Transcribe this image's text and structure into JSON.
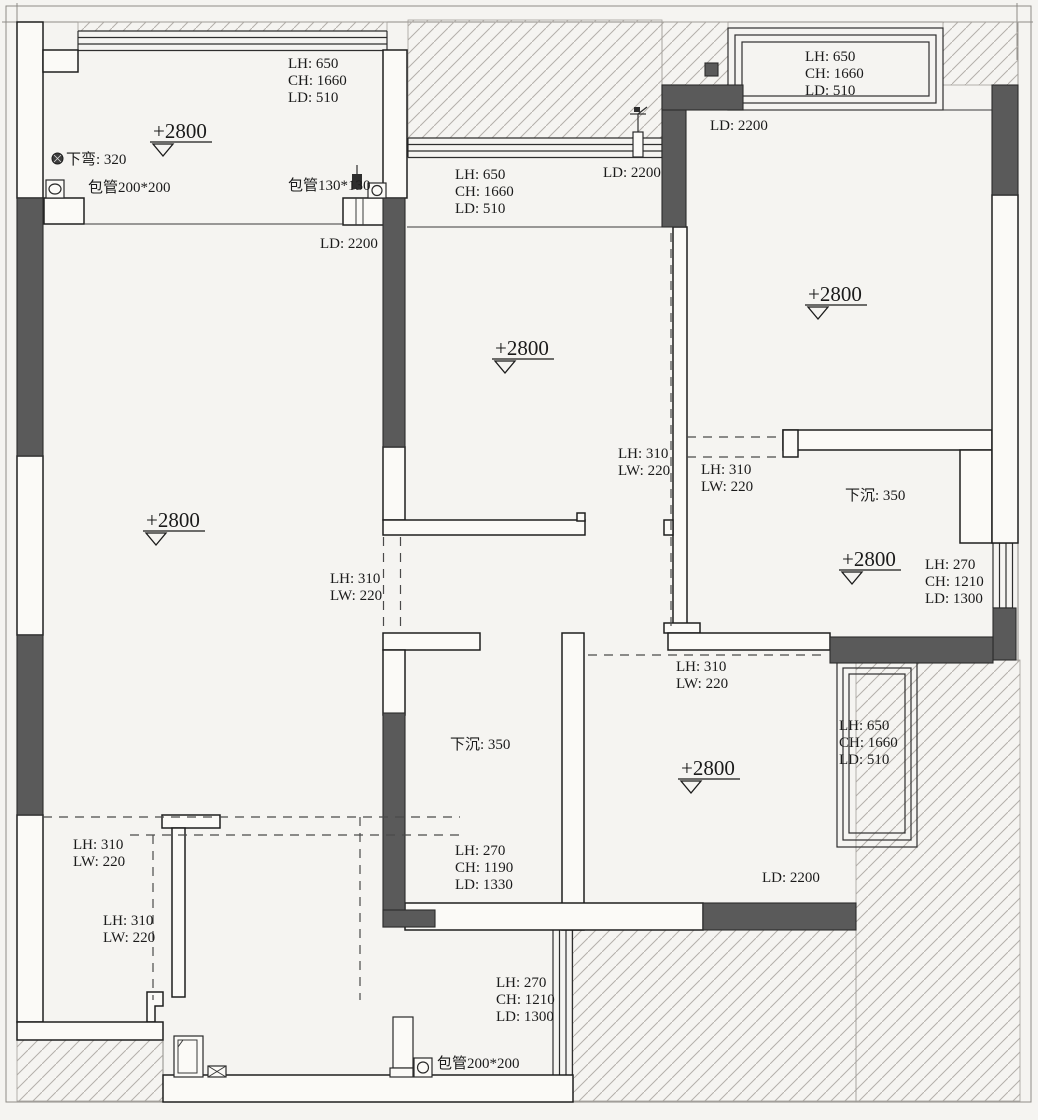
{
  "meta": {
    "drawing_type": "residential floor plan (ceiling/beam dimension plan)",
    "units": "mm"
  },
  "labels": {
    "tl_window": [
      "LH: 650",
      "CH: 1660",
      "LD: 510"
    ],
    "tl_level": "+2800",
    "down_bend": "下弯: 320",
    "wrap_pipe_left": "包管200*200",
    "wrap_pipe_mid": "包管130*130",
    "tl_curtain": "LD: 2200",
    "mid_window": [
      "LH: 650",
      "CH: 1660",
      "LD: 510"
    ],
    "mid_curtain": "LD: 2200",
    "mid_level": "+2800",
    "tr_window": [
      "LH: 650",
      "CH: 1660",
      "LD: 510"
    ],
    "tr_curtain": "LD: 2200",
    "tr_level": "+2800",
    "living_level": "+2800",
    "beam_kitchen_right": [
      "LH: 310",
      "LW: 220"
    ],
    "beam_hall_top": [
      "LH: 310",
      "LW: 220"
    ],
    "sunken_right": "下沉: 350",
    "right_level": "+2800",
    "door_right": [
      "LH: 270",
      "CH: 1210",
      "LD: 1300"
    ],
    "beam_kitchen_door": [
      "LH: 310",
      "LW: 220"
    ],
    "beam_hall_bottom": [
      "LH: 310",
      "LW: 220"
    ],
    "sunken_mid": "下沉: 350",
    "br_level": "+2800",
    "br_window": [
      "LH: 650",
      "CH: 1660",
      "LD: 510"
    ],
    "br_curtain": "LD: 2200",
    "bath_door": [
      "LH: 270",
      "CH: 1190",
      "LD: 1330"
    ],
    "beam_bath_top": [
      "LH: 310",
      "LW: 220"
    ],
    "beam_bath_mid": [
      "LH: 310",
      "LW: 220"
    ],
    "door_bottom": [
      "LH: 270",
      "CH: 1210",
      "LD: 1300"
    ],
    "wrap_pipe_bottom": "包管200*200"
  }
}
